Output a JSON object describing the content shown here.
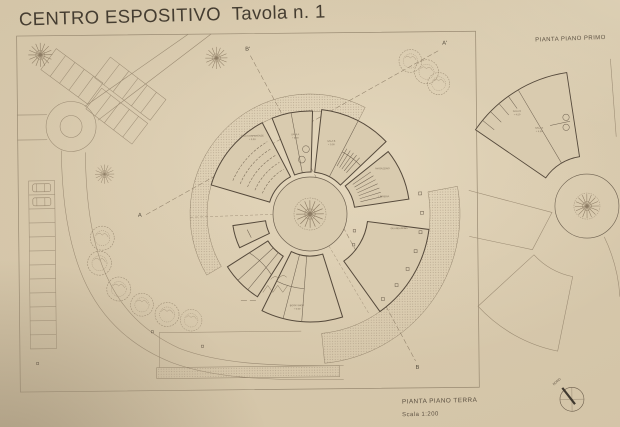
{
  "title": "CENTRO ESPOSITIVO  Tavola n. 1",
  "captions": {
    "first_floor_plan": "PIANTA PIANO PRIMO",
    "ground_floor_plan": "PIANTA PIANO TERRA",
    "scale": "Scala 1:200",
    "north": "NORD"
  },
  "section_markers": {
    "a": "A",
    "a_prime": "A'",
    "b": "B",
    "b_prime": "B'"
  },
  "rooms": {
    "conference": "SALA CONFERENZE",
    "conference_level": "+ 0.00",
    "sala_a": "SALA A",
    "sala_a_level": "+ 0.00",
    "sala_b": "SALA B",
    "sala_b_level": "+ 0.00",
    "magazzino": "MAGAZZINO",
    "libreria": "LIBRERIA",
    "guardaroba": "GUARDAROBA",
    "bookshop": "BOOK SHOP",
    "bookshop_level": "+ 0.00",
    "sala_d": "SALA D",
    "sala_d_level": "+ 4.50",
    "sala_e": "SALA E",
    "sala_e_level": "+ 4.50"
  },
  "colors": {
    "paper": "#d5c6aa",
    "faint_line": "#9a8a72",
    "wall_line": "#5d5142",
    "ink": "#453d31"
  }
}
